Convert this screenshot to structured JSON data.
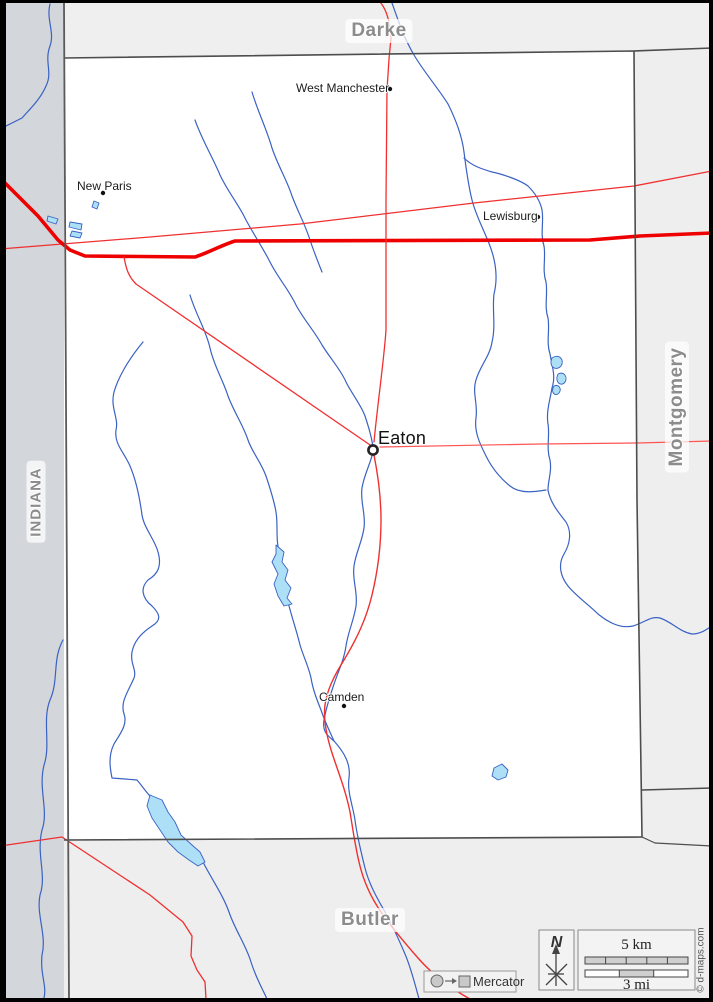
{
  "map": {
    "title_region": "Preble county blank map",
    "neighbors": {
      "north": "Darke",
      "east": "Montgomery",
      "south": "Butler",
      "west_state": "INDIANA"
    },
    "cities": [
      {
        "name": "West Manchester"
      },
      {
        "name": "New Paris"
      },
      {
        "name": "Lewisburg"
      },
      {
        "name": "Eaton",
        "county_seat": "true"
      },
      {
        "name": "Camden"
      }
    ],
    "legend": {
      "north_label": "N",
      "scale_km": "5 km",
      "scale_mi": "3 mi",
      "projection": "Mercator"
    },
    "copyright": "© d-maps.com",
    "colors": {
      "road_major": "#ee0000",
      "road_minor": "#f03030",
      "river": "#3a62c4",
      "lake_fill": "#ade0f7",
      "state_band": "#d3d6da",
      "neighbor_fill": "#efefef",
      "boundary": "#4d4d4d",
      "region_label": "#8c8c8c"
    }
  }
}
